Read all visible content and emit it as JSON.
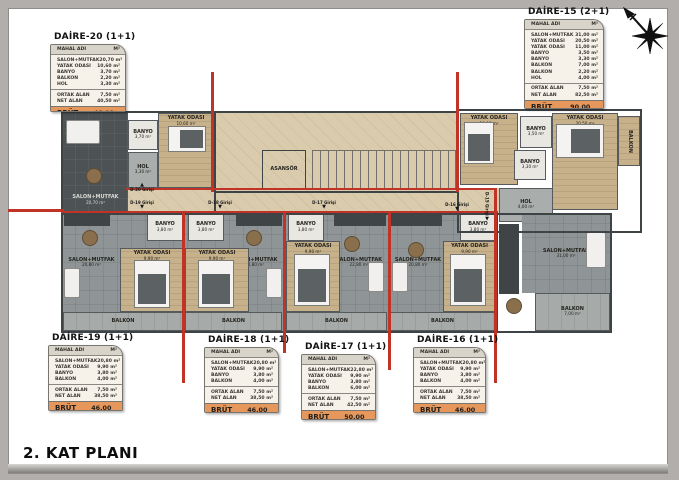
{
  "title": "2. KAT PLANI",
  "header": {
    "col_name": "MAHAL ADI",
    "col_area": "M²"
  },
  "colors": {
    "red_wall": "#c23327",
    "accent_orange": "#e6975b",
    "corridor": "#dacbad",
    "floor_gray": "#8f9596",
    "wood": "#c7b18b"
  },
  "tables": [
    {
      "id": "daire-20",
      "title": "DAİRE-20 (1+1)",
      "rows": [
        {
          "label": "SALON+MUTFAK",
          "value": "20,70 m²"
        },
        {
          "label": "YATAK ODASI",
          "value": "10,60 m²"
        },
        {
          "label": "BANYO",
          "value": "3,70 m²"
        },
        {
          "label": "BALKON",
          "value": "2,20 m²"
        },
        {
          "label": "HOL",
          "value": "3,30 m²"
        }
      ],
      "totals": [
        {
          "label": "ORTAK ALAN",
          "value": "7,50 m²"
        },
        {
          "label": "NET ALAN",
          "value": "40,50 m²"
        }
      ],
      "brut_label": "BRÜT ALAN",
      "brut_value": "48,00 m²"
    },
    {
      "id": "daire-15",
      "title": "DAİRE-15 (2+1)",
      "rows": [
        {
          "label": "SALON+MUTFAK",
          "value": "31,00 m²"
        },
        {
          "label": "YATAK ODASI",
          "value": "20,50 m²"
        },
        {
          "label": "YATAK ODASI",
          "value": "11,00 m²"
        },
        {
          "label": "BANYO",
          "value": "3,50 m²"
        },
        {
          "label": "BANYO",
          "value": "3,30 m²"
        },
        {
          "label": "BALKON",
          "value": "7,00 m²"
        },
        {
          "label": "BALKON",
          "value": "2,20 m²"
        },
        {
          "label": "HOL",
          "value": "4,00 m²"
        }
      ],
      "totals": [
        {
          "label": "ORTAK ALAN",
          "value": "7,50 m²"
        },
        {
          "label": "NET ALAN",
          "value": "82,50 m²"
        }
      ],
      "brut_label": "BRÜT ALAN",
      "brut_value": "90,00 m²"
    },
    {
      "id": "daire-19",
      "title": "DAİRE-19 (1+1)",
      "rows": [
        {
          "label": "SALON+MUTFAK",
          "value": "20,80 m²"
        },
        {
          "label": "YATAK ODASI",
          "value": "9,90 m²"
        },
        {
          "label": "BANYO",
          "value": "3,80 m²"
        },
        {
          "label": "BALKON",
          "value": "4,00 m²"
        }
      ],
      "totals": [
        {
          "label": "ORTAK ALAN",
          "value": "7,50 m²"
        },
        {
          "label": "NET ALAN",
          "value": "38,50 m²"
        }
      ],
      "brut_label": "BRÜT ALAN",
      "brut_value": "46,00 m²"
    },
    {
      "id": "daire-18",
      "title": "DAİRE-18 (1+1)",
      "rows": [
        {
          "label": "SALON+MUTFAK",
          "value": "20,80 m²"
        },
        {
          "label": "YATAK ODASI",
          "value": "9,90 m²"
        },
        {
          "label": "BANYO",
          "value": "3,80 m²"
        },
        {
          "label": "BALKON",
          "value": "4,00 m²"
        }
      ],
      "totals": [
        {
          "label": "ORTAK ALAN",
          "value": "7,50 m²"
        },
        {
          "label": "NET ALAN",
          "value": "38,50 m²"
        }
      ],
      "brut_label": "BRÜT ALAN",
      "brut_value": "46,00 m²"
    },
    {
      "id": "daire-17",
      "title": "DAİRE-17 (1+1)",
      "rows": [
        {
          "label": "SALON+MUTFAK",
          "value": "22,80 m²"
        },
        {
          "label": "YATAK ODASI",
          "value": "9,90 m²"
        },
        {
          "label": "BANYO",
          "value": "3,80 m²"
        },
        {
          "label": "BALKON",
          "value": "6,00 m²"
        }
      ],
      "totals": [
        {
          "label": "ORTAK ALAN",
          "value": "7,50 m²"
        },
        {
          "label": "NET ALAN",
          "value": "42,50 m²"
        }
      ],
      "brut_label": "BRÜT ALAN",
      "brut_value": "50,00 m²"
    },
    {
      "id": "daire-16",
      "title": "DAİRE-16 (1+1)",
      "rows": [
        {
          "label": "SALON+MUTFAK",
          "value": "20,80 m²"
        },
        {
          "label": "YATAK ODASI",
          "value": "9,90 m²"
        },
        {
          "label": "BANYO",
          "value": "3,80 m²"
        },
        {
          "label": "BALKON",
          "value": "4,00 m²"
        }
      ],
      "totals": [
        {
          "label": "ORTAK ALAN",
          "value": "7,50 m²"
        },
        {
          "label": "NET ALAN",
          "value": "38,50 m²"
        }
      ],
      "brut_label": "BRÜT ALAN",
      "brut_value": "46,00 m²"
    }
  ],
  "plan": {
    "rooms": [
      {
        "label": "SALON+MUTFAK",
        "area": "20,70 m²"
      },
      {
        "label": "BANYO",
        "area": "3,70 m²"
      },
      {
        "label": "HOL",
        "area": "3,30 m²"
      },
      {
        "label": "YATAK ODASI",
        "area": "10,60 m²"
      },
      {
        "label": "ASANSÖR",
        "area": ""
      },
      {
        "label": "YATAK ODASI",
        "area": "11,00 m²"
      },
      {
        "label": "BANYO",
        "area": "3,50 m²"
      },
      {
        "label": "BANYO",
        "area": "3,30 m²"
      },
      {
        "label": "YATAK ODASI",
        "area": "20,50 m²"
      },
      {
        "label": "BALKON",
        "area": "2,20 m²"
      },
      {
        "label": "HOL",
        "area": "4,00 m²"
      },
      {
        "label": "SALON+MUTFAK",
        "area": "31,00 m²"
      },
      {
        "label": "BALKON",
        "area": "7,00 m²"
      },
      {
        "label": "BANYO",
        "area": "3,80 m²"
      },
      {
        "label": "SALON+MUTFAK",
        "area": "20,80 m²"
      },
      {
        "label": "YATAK ODASI",
        "area": "9,90 m²"
      },
      {
        "label": "BALKON",
        "area": "4,00 m²"
      },
      {
        "label": "BANYO",
        "area": "3,80 m²"
      },
      {
        "label": "SALON+MUTFAK",
        "area": "20,80 m²"
      },
      {
        "label": "YATAK ODASI",
        "area": "9,90 m²"
      },
      {
        "label": "BALKON",
        "area": "4,00 m²"
      },
      {
        "label": "BANYO",
        "area": "3,80 m²"
      },
      {
        "label": "SALON+MUTFAK",
        "area": "22,80 m²"
      },
      {
        "label": "YATAK ODASI",
        "area": "9,90 m²"
      },
      {
        "label": "BALKON",
        "area": "6,00 m²"
      },
      {
        "label": "BANYO",
        "area": "3,80 m²"
      },
      {
        "label": "SALON+MUTFAK",
        "area": "20,80 m²"
      },
      {
        "label": "YATAK ODASI",
        "area": "9,90 m²"
      },
      {
        "label": "BALKON",
        "area": "4,00 m²"
      }
    ],
    "entrances": [
      {
        "label": "D-20 Girişi"
      },
      {
        "label": "D-19 Girişi"
      },
      {
        "label": "D-18 Girişi"
      },
      {
        "label": "D-17 Girişi"
      },
      {
        "label": "D-16 Girişi"
      },
      {
        "label": "D-15 Girişi"
      }
    ]
  }
}
